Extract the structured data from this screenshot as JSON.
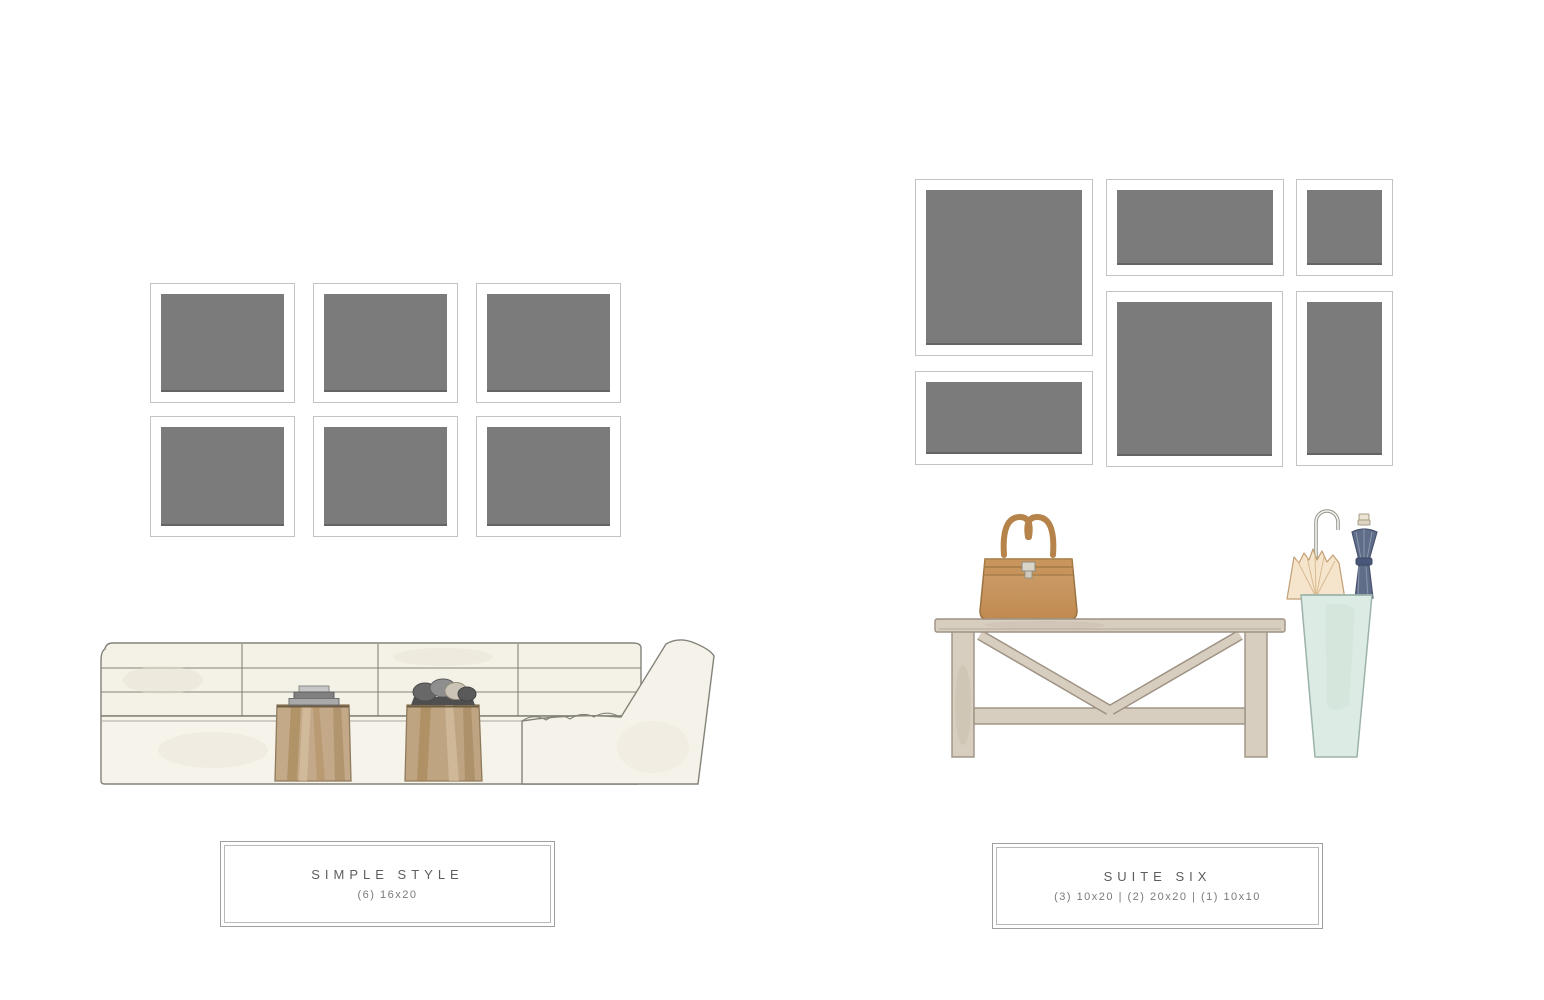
{
  "page": {
    "background": "#ffffff",
    "description_note": ""
  },
  "palette": {
    "frame_fill": "#7b7b7b",
    "frame_border": "#c3c3c3",
    "frame_mat": "#ffffff",
    "caption_border": "#9f9f9f",
    "caption_title_text": "#5d5d5d",
    "caption_subtitle_text": "#7a7a7a",
    "sofa_cream": "#f4f1e7",
    "wood_brown": "#c3a988",
    "console_taupe": "#d8cec0",
    "bag_tan": "#c89a60",
    "stand_mint": "#dcebe3",
    "umbrella_navy": "#5f6d88",
    "umbrella_cream": "#f6e5cd"
  },
  "left_display": {
    "title": "SIMPLE STYLE",
    "subtitle": "(6) 16x20",
    "frames": [
      {
        "size": "16x20",
        "x": 150,
        "y": 283,
        "w": 145,
        "h": 120
      },
      {
        "size": "16x20",
        "x": 313,
        "y": 283,
        "w": 145,
        "h": 120
      },
      {
        "size": "16x20",
        "x": 476,
        "y": 283,
        "w": 145,
        "h": 120
      },
      {
        "size": "16x20",
        "x": 150,
        "y": 416,
        "w": 145,
        "h": 121
      },
      {
        "size": "16x20",
        "x": 313,
        "y": 416,
        "w": 145,
        "h": 121
      },
      {
        "size": "16x20",
        "x": 476,
        "y": 416,
        "w": 145,
        "h": 121
      }
    ]
  },
  "right_display": {
    "title": "SUITE SIX",
    "subtitle": "(3) 10x20 | (2) 20x20 | (1) 10x10",
    "frames": [
      {
        "size": "20x20",
        "x": 915,
        "y": 179,
        "w": 178,
        "h": 177
      },
      {
        "size": "10x20",
        "x": 915,
        "y": 371,
        "w": 178,
        "h": 94
      },
      {
        "size": "10x20",
        "x": 1106,
        "y": 179,
        "w": 178,
        "h": 97
      },
      {
        "size": "20x20",
        "x": 1106,
        "y": 291,
        "w": 177,
        "h": 176
      },
      {
        "size": "10x10",
        "x": 1296,
        "y": 179,
        "w": 97,
        "h": 97
      },
      {
        "size": "10x20",
        "x": 1296,
        "y": 291,
        "w": 97,
        "h": 175
      }
    ]
  }
}
